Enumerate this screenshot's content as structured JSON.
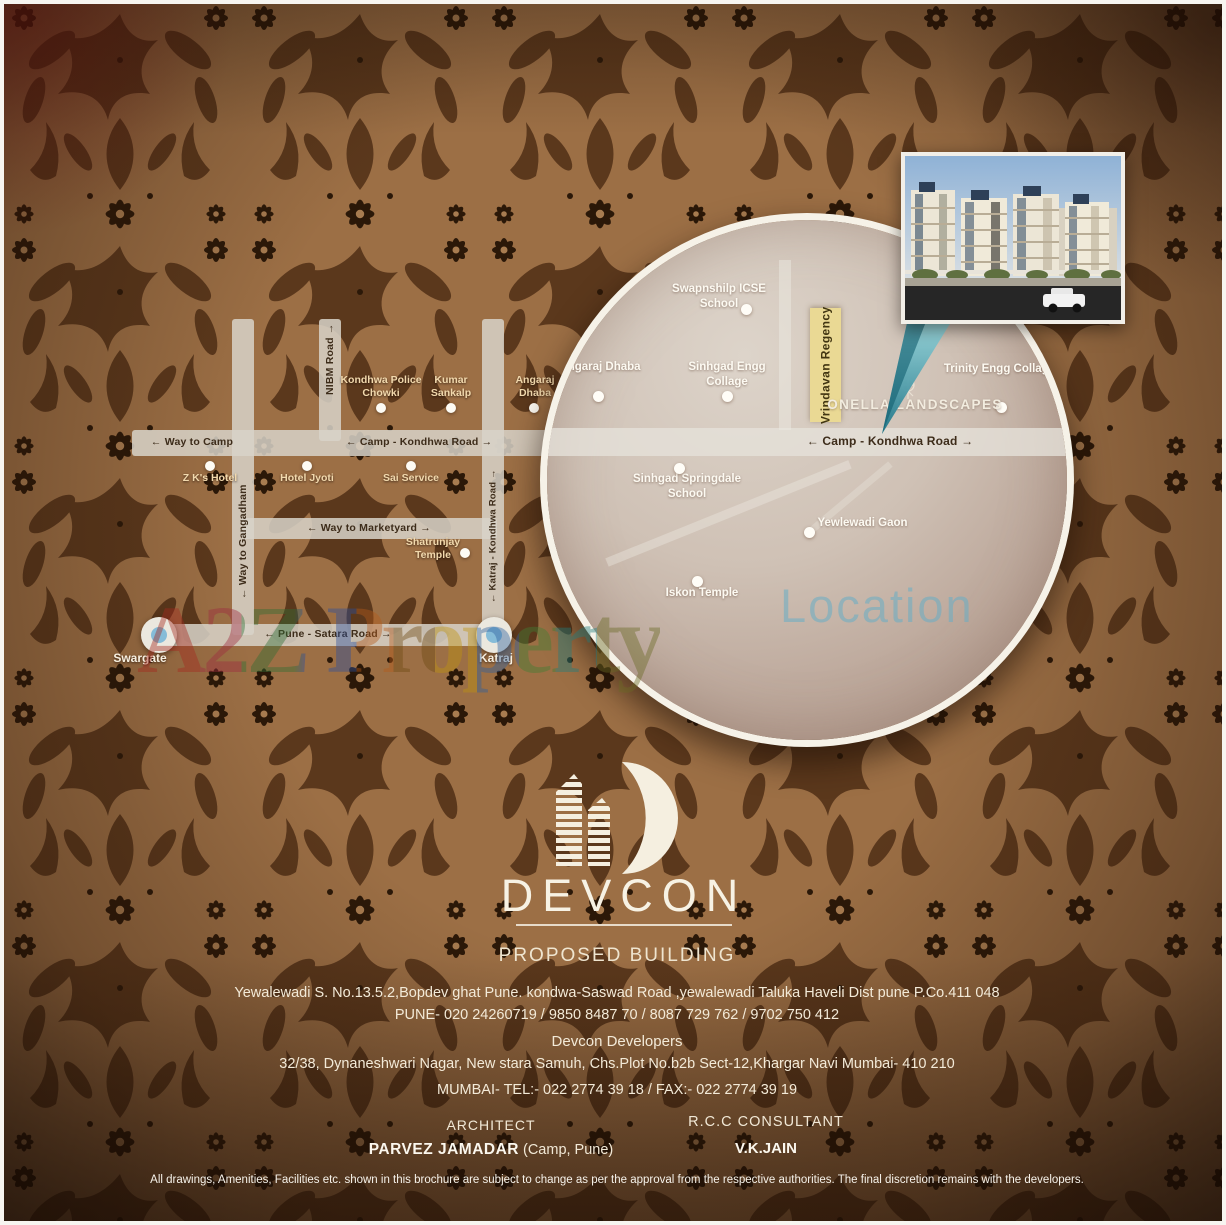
{
  "brand": {
    "logo_text": "DEVCON",
    "section_title": "PROPOSED BUILDING"
  },
  "building_info": {
    "address_line": "Yewalewadi S. No.13.5.2,Bopdev ghat Pune. kondwa-Saswad Road ,yewalewadi Taluka Haveli Dist pune P.Co.411 048",
    "pune_phones": "PUNE- 020 24260719 / 9850 8487 70 / 8087 729 762 / 9702 750 412",
    "developer_name": "Devcon Developers",
    "developer_address": "32/38, Dynaneshwari Nagar, New stara Samuh, Chs.Plot No.b2b Sect-12,Khargar Navi Mumbai- 410 210",
    "mumbai_contact": "MUMBAI- TEL:- 022 2774 39 18 / FAX:- 022 2774 39 19"
  },
  "consultants": {
    "architect_title": "ARCHITECT",
    "architect_name": "PARVEZ JAMADAR",
    "architect_location": " (Camp, Pune)",
    "rcc_title": "R.C.C CONSULTANT",
    "rcc_name": "V.K.JAIN"
  },
  "disclaimer": "All drawings, Amenities, Facilities etc. shown in this brochure are subject to change as per the approval from the respective authorities. The final discretion remains with the developers.",
  "watermark_text": "A2Z Property",
  "left_map": {
    "road_labels": {
      "way_to_camp": "← Way to Camp",
      "camp_kondhwa": "← Camp - Kondhwa Road →",
      "nibm": "NIBM Road →",
      "gangadham": "← Way to Gangadham",
      "marketyard": "← Way to Marketyard →",
      "katraj_kondhwa": "← Katraj - Kondhwa Road →",
      "pune_satara": "← Pune - Satara Road →"
    },
    "places": {
      "zk_hotel": "Z K's Hotel",
      "hotel_jyoti": "Hotel Jyoti",
      "sai_service": "Sai Service",
      "police_chowki": "Kondhwa Police Chowki",
      "kumar_sankalp": "Kumar Sankalp",
      "angaraj_dhaba": "Angaraj Dhaba",
      "shatrunjay": "Shatrunjay Temple",
      "swargate": "Swargate",
      "katraj": "Katraj"
    }
  },
  "circle_map": {
    "watermark": "Location",
    "road_label": "← Camp - Kondhwa Road →",
    "highlight_label": "Vrindavan Regency",
    "landmark": "ONELLA LANDSCAPES",
    "places": {
      "swapnshilp": "Swapnshilp ICSE School",
      "angaraj_dhaba": "Angaraj Dhaba",
      "sinhgad_engg": "Sinhgad Engg Collage",
      "springdale": "Sinhgad Springdale School",
      "yewlewadi": "Yewlewadi Gaon",
      "iskon": "Iskon Temple",
      "trinity": "Trinity Engg Collage"
    }
  },
  "colors": {
    "wallpaper_base": "#9c6f45",
    "wallpaper_motif": "#553319",
    "road_gray": "#d8d3c9",
    "highlight_yellow": "#ead994",
    "pointer_teal": "#1d7487",
    "location_watermark_teal": "#67adc5",
    "cream_text": "#f3ead8"
  }
}
